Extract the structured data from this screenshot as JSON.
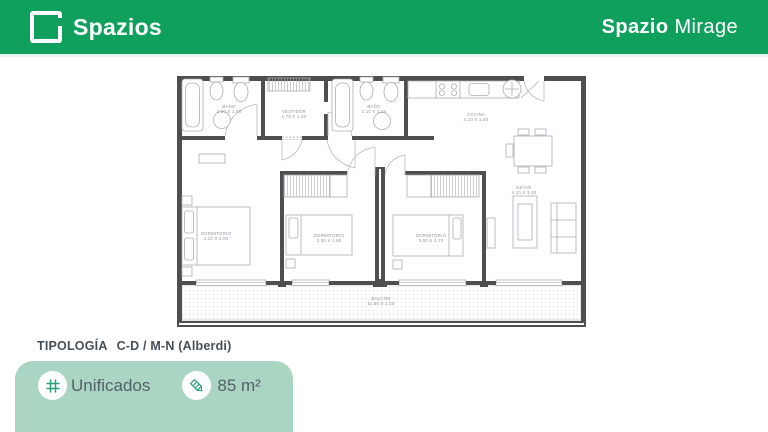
{
  "header": {
    "brand": "Spazios",
    "project_bold": "Spazio",
    "project_light": "Mirage",
    "bg_color": "#10a05e"
  },
  "footer": {
    "typology_label": "TIPOLOGÍA",
    "typology_value": "C-D / M-N (Alberdi)",
    "badge": {
      "unified_label": "Unificados",
      "area_label": "85 m²",
      "bg_color": "#abd5c3",
      "icon_color": "#2f9f7c"
    }
  },
  "floor_plan": {
    "wall_color": "#4f4f4f",
    "fixture_color": "#a9aeb4",
    "label_color": "#8e939a",
    "rooms": [
      {
        "name": "BAÑO",
        "dims": "2.20 X 1.60",
        "x": 60,
        "y": 46
      },
      {
        "name": "VESTIDOR",
        "dims": "1.70 X 1.60",
        "x": 125,
        "y": 51
      },
      {
        "name": "BAÑO",
        "dims": "2.10 X 1.60",
        "x": 205,
        "y": 46
      },
      {
        "name": "COCINA",
        "dims": "4.10 X 1.60",
        "x": 307,
        "y": 54
      },
      {
        "name": "DORMITORIO",
        "dims": "4.10 X 2.80",
        "x": 47,
        "y": 173
      },
      {
        "name": "DORMITORIO",
        "dims": "3.00 X 2.50",
        "x": 160,
        "y": 175
      },
      {
        "name": "DORMITORIO",
        "dims": "3.00 X 2.70",
        "x": 262,
        "y": 175
      },
      {
        "name": "ESTAR",
        "dims": "4.10 X 3.00",
        "x": 355,
        "y": 127
      },
      {
        "name": "BALCÓN",
        "dims": "11.50 X 1.30",
        "x": 212,
        "y": 238
      }
    ]
  }
}
